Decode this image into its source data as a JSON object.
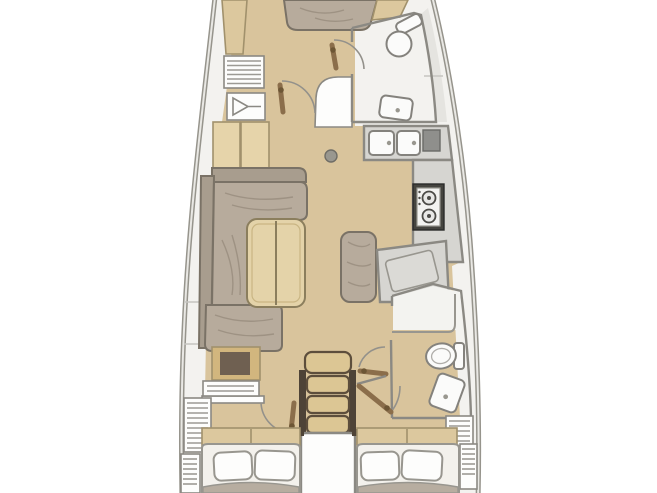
{
  "diagram": {
    "label": "Sailboat interior floor plan, bow up",
    "rooms": [
      {
        "name": "forward-cabin",
        "icons": [
          "v-berth-bed",
          "hanging-locker",
          "vent-locker",
          "wardrobe"
        ]
      },
      {
        "name": "forward-head",
        "icons": [
          "toilet",
          "sink",
          "door-arc"
        ]
      },
      {
        "name": "salon",
        "icons": [
          "l-shaped-sofa",
          "chaise",
          "folding-table",
          "mast-post"
        ]
      },
      {
        "name": "galley",
        "icons": [
          "double-sink",
          "cooler-hatch",
          "two-burner-stove",
          "counter"
        ]
      },
      {
        "name": "nav-station",
        "icons": [
          "bench-seat",
          "chart-table"
        ]
      },
      {
        "name": "aft-head",
        "icons": [
          "shower",
          "toilet",
          "sink",
          "door-arc"
        ]
      },
      {
        "name": "companionway",
        "icons": [
          "stairs-four-steps",
          "engine-box"
        ]
      },
      {
        "name": "port-aft-cabin",
        "icons": [
          "double-bed",
          "two-pillows",
          "dresser",
          "shelf",
          "louver-locker",
          "door-arc"
        ]
      },
      {
        "name": "starboard-aft-cabin",
        "icons": [
          "double-bed",
          "two-pillows",
          "louver-locker",
          "door-arc"
        ]
      }
    ]
  },
  "colors": {
    "bg": "#ffffff",
    "hull_line": "#96948c",
    "hull_inner": "#e9e8e4",
    "deck": "#f3f2ef",
    "deck_shade": "#e5e4e0",
    "seam": "#c6c5c1",
    "floor": "#d9c49c",
    "wood": "#e6d4aa",
    "wood_dark": "#d2b67e",
    "wood_edge": "#a1916c",
    "headboard": "#dcc89e",
    "upholstery": "#b7ab9c",
    "uph_back": "#a89d8e",
    "uph_line": "#7a7266",
    "wall": "#8b8983",
    "room_white": "#fdfdfc",
    "shower": "#f3f3f0",
    "counter": "#d6d5d1",
    "counter_dark": "#cdccc8",
    "appliance": "#fbfbfa",
    "fixture_line": "#84827d",
    "dark_module": "#8f8f8c",
    "stove_frame": "#45443f",
    "stove_panel": "#f3f3f1",
    "burner": "#4c4b47",
    "arc": "#93918b",
    "leaf": "#8b6e4b",
    "handle": "#6d5635",
    "step": "#dcc694",
    "step_edge": "#5d4e3c",
    "rail": "#4e4337",
    "bed": "#f3f1ec",
    "pillow": "#fdfdfc",
    "pillow_line": "#98968f",
    "blanket": "#b7ada0",
    "hatch": "#9c9a94",
    "mast": "#99978f",
    "dresser_dark": "#6f6051",
    "table": "#e4d3a9",
    "table_edge": "#8b7e5d",
    "chart": "#dbdad6"
  }
}
